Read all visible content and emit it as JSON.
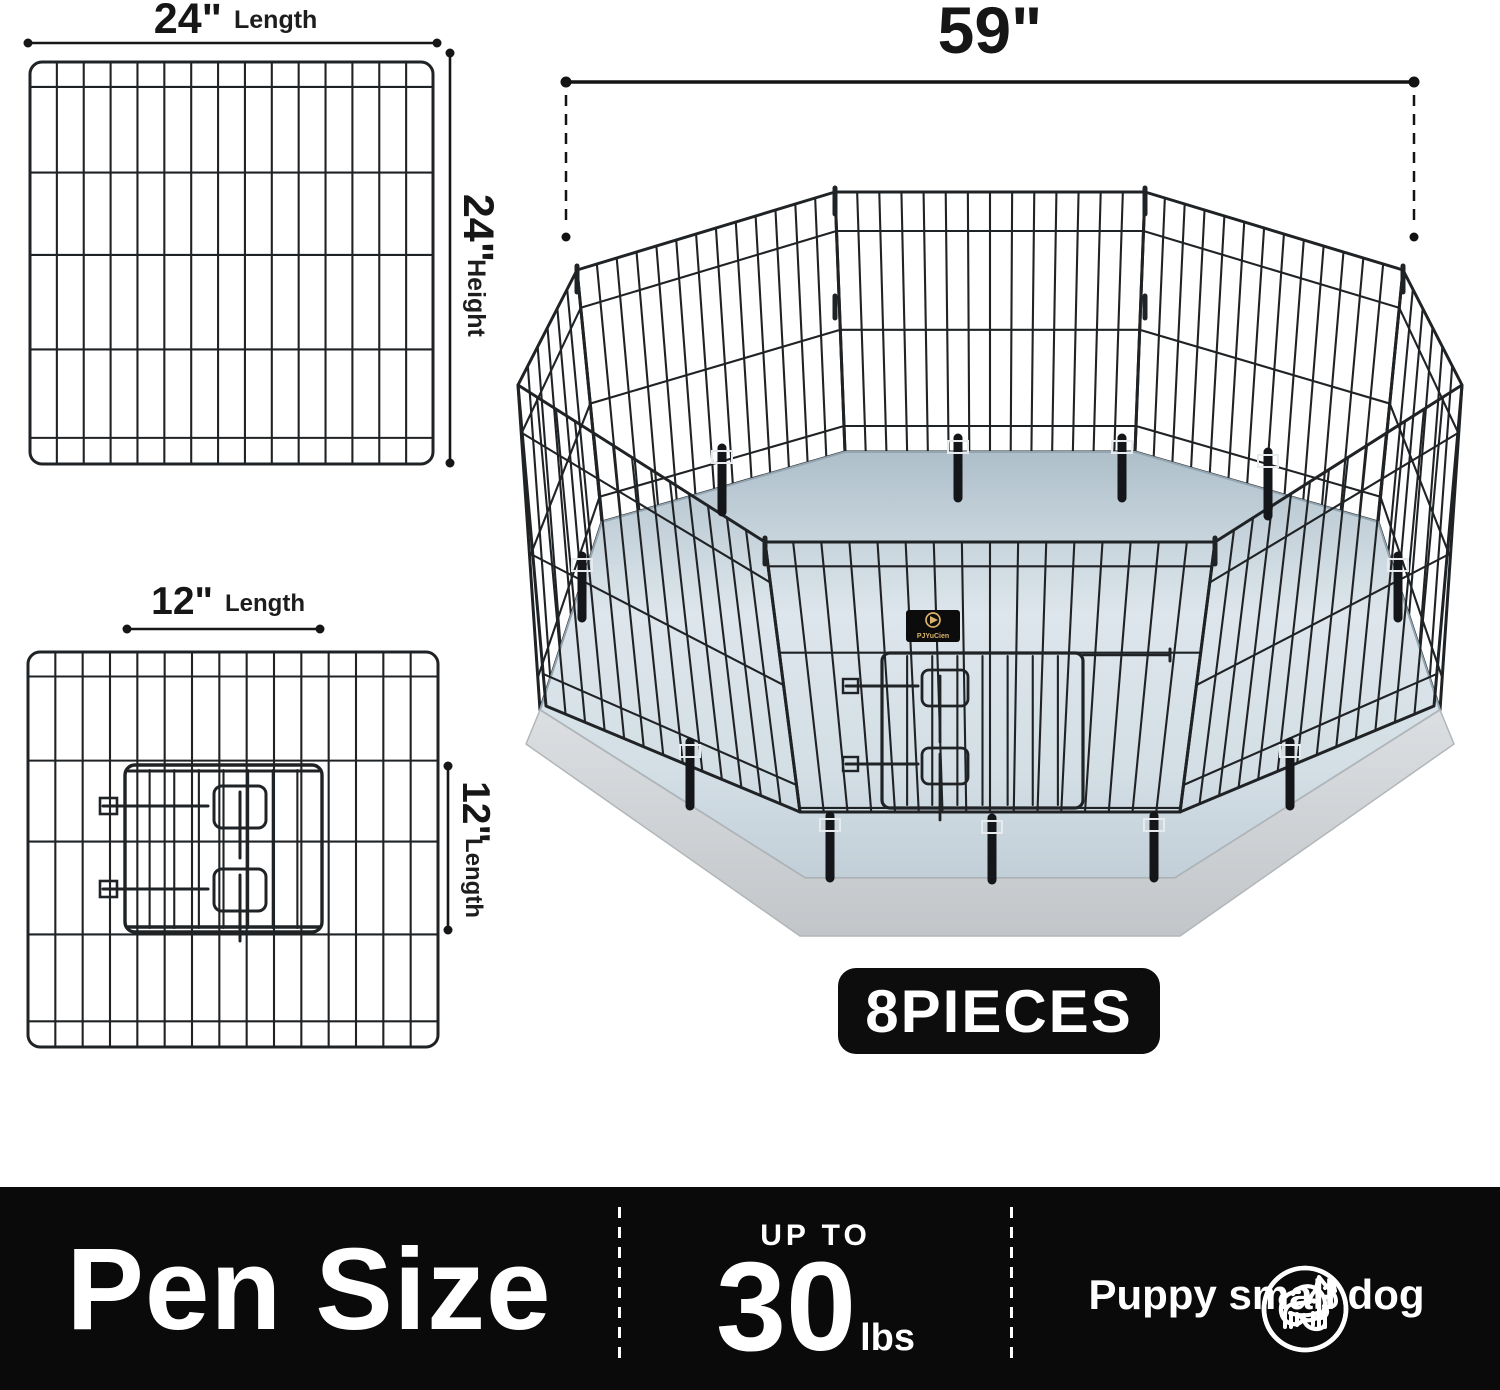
{
  "large_panel": {
    "length_value": "24\"",
    "length_unit": "Length",
    "height_value": "24\"",
    "height_unit": "Height"
  },
  "small_panel": {
    "length_value": "12\"",
    "length_unit": "Length",
    "height_value": "12\"",
    "height_unit": "Length"
  },
  "pen": {
    "width_value": "59\"",
    "pieces_badge": "8PIECES",
    "brand": "PJYuCien"
  },
  "footer": {
    "title": "Pen Size",
    "up_to_label": "UP TO",
    "weight_value": "30",
    "weight_unit": "lbs",
    "caption": "Puppy small dog"
  },
  "icons": {
    "left": "puppy-face-icon",
    "right": "small-dog-icon"
  },
  "colors": {
    "footer_bg": "#0a0a0a",
    "badge_bg": "#0d0d0d",
    "wire": "#202325",
    "floor_light": "#e3ebf0",
    "floor_dark": "#b2c1cb",
    "base_band": "#ced2d5",
    "brand_gold": "#d9b36a"
  }
}
